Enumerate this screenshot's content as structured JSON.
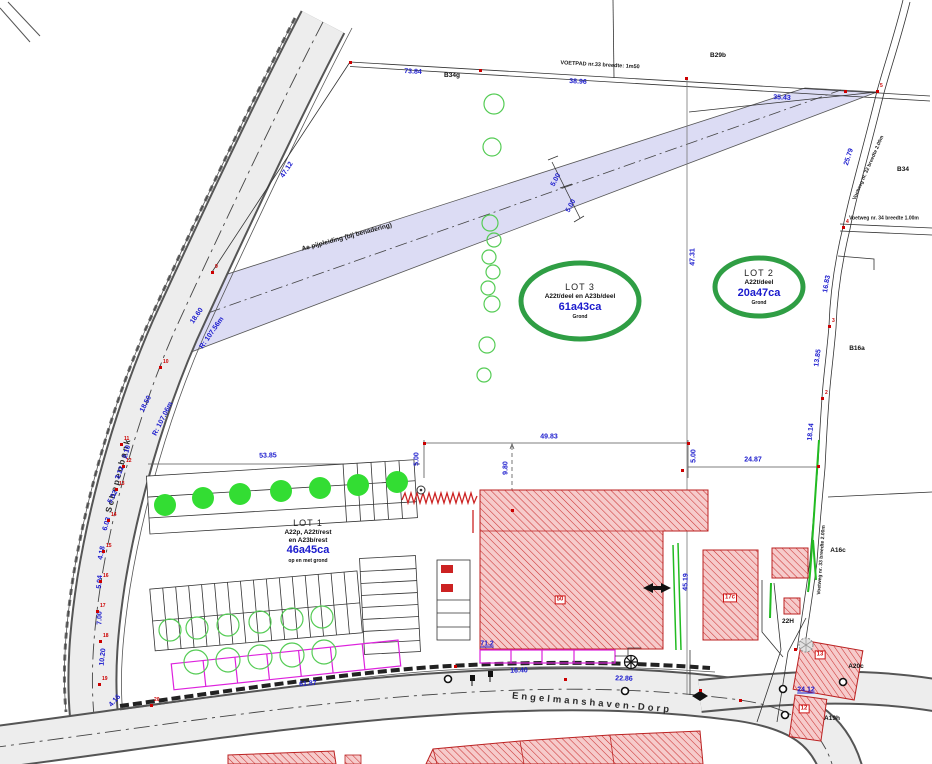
{
  "drawing": {
    "road_labels": {
      "left": "Schepenbank",
      "bottom": "Engelmanshaven-Dorp"
    },
    "lots": [
      {
        "name": "LOT 1",
        "parcels": "A22p, A22t/rest",
        "parcels2": "en A23b/rest",
        "area": "46a45ca",
        "note": "op en met grond"
      },
      {
        "name": "LOT 2",
        "parcels": "A22t/deel",
        "area": "20a47ca",
        "note": "Grond"
      },
      {
        "name": "LOT 3",
        "parcels": "A22t/deel en A23b/deel",
        "area": "61a43ca",
        "note": "Grond"
      }
    ],
    "path_labels": [
      {
        "t": "VOETPAD nr.33 breedte: 1m50",
        "x": 600,
        "y": 66,
        "r": 3,
        "s": 5.5
      },
      {
        "t": "Voetweg nr. 32 breedte 2.00m",
        "x": 869,
        "y": 168,
        "r": -66,
        "s": 5
      },
      {
        "t": "Voetweg nr. 34 breedte 1.00m",
        "x": 884,
        "y": 219,
        "r": 0,
        "s": 5
      },
      {
        "t": "Voetweg nr. 33 breedte 2.00m",
        "x": 822,
        "y": 560,
        "r": -86,
        "s": 5
      },
      {
        "t": "Ae pijpleiding (bij benadering)",
        "x": 347,
        "y": 238,
        "r": -15,
        "s": 6.5
      }
    ],
    "dimensions": [
      {
        "t": "73.84",
        "x": 413,
        "y": 72,
        "r": 3
      },
      {
        "t": "38.96",
        "x": 578,
        "y": 82,
        "r": 3
      },
      {
        "t": "35.43",
        "x": 782,
        "y": 98,
        "r": 3
      },
      {
        "t": "25.79",
        "x": 849,
        "y": 157,
        "r": -72
      },
      {
        "t": "16.83",
        "x": 827,
        "y": 284,
        "r": -80
      },
      {
        "t": "13.85",
        "x": 818,
        "y": 358,
        "r": -82
      },
      {
        "t": "18.14",
        "x": 811,
        "y": 432,
        "r": -84
      },
      {
        "t": "47.12",
        "x": 287,
        "y": 170,
        "r": -57
      },
      {
        "t": "18.60",
        "x": 197,
        "y": 316,
        "r": -55
      },
      {
        "t": "R: 107.56m",
        "x": 212,
        "y": 333,
        "r": -55
      },
      {
        "t": "18.50",
        "x": 146,
        "y": 404,
        "r": -63
      },
      {
        "t": "R: 107.06m",
        "x": 163,
        "y": 419,
        "r": -63
      },
      {
        "t": "2.10",
        "x": 127,
        "y": 452,
        "r": -75
      },
      {
        "t": "3.12",
        "x": 120,
        "y": 473,
        "r": -68
      },
      {
        "t": "5.32",
        "x": 113,
        "y": 497,
        "r": -62
      },
      {
        "t": "6.03",
        "x": 107,
        "y": 524,
        "r": -73
      },
      {
        "t": "4.18",
        "x": 102,
        "y": 553,
        "r": -79
      },
      {
        "t": "5.04",
        "x": 100,
        "y": 582,
        "r": -85
      },
      {
        "t": "7.00",
        "x": 100,
        "y": 618,
        "r": -89
      },
      {
        "t": "10.20",
        "x": 103,
        "y": 657,
        "r": -84
      },
      {
        "t": "4.16",
        "x": 115,
        "y": 701,
        "r": -48
      },
      {
        "t": "53.85",
        "x": 268,
        "y": 456,
        "r": -2
      },
      {
        "t": "49.83",
        "x": 549,
        "y": 437,
        "r": 0
      },
      {
        "t": "9.80",
        "x": 506,
        "y": 468,
        "r": -90
      },
      {
        "t": "5.00",
        "x": 417,
        "y": 459,
        "r": -90
      },
      {
        "t": "5.00",
        "x": 694,
        "y": 456,
        "r": -90
      },
      {
        "t": "24.87",
        "x": 753,
        "y": 460,
        "r": 0
      },
      {
        "t": "47.31",
        "x": 693,
        "y": 257,
        "r": -90
      },
      {
        "t": "5.00",
        "x": 556,
        "y": 180,
        "r": -62
      },
      {
        "t": "5.00",
        "x": 571,
        "y": 206,
        "r": -62
      },
      {
        "t": "45.19",
        "x": 686,
        "y": 582,
        "r": -88
      },
      {
        "t": "61.87",
        "x": 308,
        "y": 684,
        "r": -5
      },
      {
        "t": "16.40",
        "x": 519,
        "y": 671,
        "r": -2
      },
      {
        "t": "22.86",
        "x": 624,
        "y": 679,
        "r": 2
      },
      {
        "t": "71.2",
        "x": 487,
        "y": 644,
        "r": 0,
        "u": true
      },
      {
        "t": "24.12",
        "x": 806,
        "y": 690,
        "r": 0,
        "u": true
      }
    ],
    "parcel_labels": [
      {
        "t": "B34g",
        "x": 452,
        "y": 76
      },
      {
        "t": "B29b",
        "x": 718,
        "y": 56
      },
      {
        "t": "B34",
        "x": 903,
        "y": 170
      },
      {
        "t": "B16a",
        "x": 857,
        "y": 349
      },
      {
        "t": "A16c",
        "x": 838,
        "y": 551
      },
      {
        "t": "22H",
        "x": 788,
        "y": 622
      },
      {
        "t": "A20c",
        "x": 856,
        "y": 667
      },
      {
        "t": "A19h",
        "x": 832,
        "y": 719
      }
    ],
    "boxed_labels": [
      {
        "t": "50",
        "x": 560,
        "y": 600
      },
      {
        "t": "17c",
        "x": 730,
        "y": 598
      },
      {
        "t": "13",
        "x": 820,
        "y": 655
      },
      {
        "t": "12",
        "x": 804,
        "y": 709
      }
    ],
    "points": [
      {
        "x": 350,
        "y": 62
      },
      {
        "x": 480,
        "y": 70
      },
      {
        "x": 686,
        "y": 78
      },
      {
        "x": 845,
        "y": 91
      },
      {
        "x": 877,
        "y": 91,
        "n": "5"
      },
      {
        "x": 843,
        "y": 227,
        "n": "4"
      },
      {
        "x": 829,
        "y": 326,
        "n": "3"
      },
      {
        "x": 822,
        "y": 398,
        "n": "2"
      },
      {
        "x": 212,
        "y": 272,
        "n": "9"
      },
      {
        "x": 160,
        "y": 367,
        "n": "10"
      },
      {
        "x": 121,
        "y": 444,
        "n": "11"
      },
      {
        "x": 123,
        "y": 466,
        "n": "12"
      },
      {
        "x": 116,
        "y": 489,
        "n": "13"
      },
      {
        "x": 108,
        "y": 520,
        "n": "14"
      },
      {
        "x": 103,
        "y": 551,
        "n": "15"
      },
      {
        "x": 100,
        "y": 581,
        "n": "16"
      },
      {
        "x": 97,
        "y": 611,
        "n": "17"
      },
      {
        "x": 100,
        "y": 641,
        "n": "18"
      },
      {
        "x": 99,
        "y": 684,
        "n": "19"
      },
      {
        "x": 151,
        "y": 705,
        "n": "20"
      },
      {
        "x": 424,
        "y": 443
      },
      {
        "x": 688,
        "y": 443
      },
      {
        "x": 682,
        "y": 470
      },
      {
        "x": 818,
        "y": 466
      },
      {
        "x": 455,
        "y": 666
      },
      {
        "x": 565,
        "y": 679
      },
      {
        "x": 700,
        "y": 690
      },
      {
        "x": 740,
        "y": 700
      },
      {
        "x": 795,
        "y": 649
      },
      {
        "x": 512,
        "y": 510
      }
    ],
    "trees_solid": [
      [
        165,
        505
      ],
      [
        203,
        498
      ],
      [
        240,
        494
      ],
      [
        281,
        491
      ],
      [
        320,
        488
      ],
      [
        358,
        485
      ],
      [
        397,
        482
      ]
    ],
    "trees_outline": [
      [
        494,
        104,
        10
      ],
      [
        492,
        147,
        9
      ],
      [
        490,
        223,
        8
      ],
      [
        494,
        240,
        7
      ],
      [
        489,
        257,
        7
      ],
      [
        493,
        272,
        7
      ],
      [
        488,
        288,
        7
      ],
      [
        492,
        304,
        8
      ],
      [
        487,
        345,
        8
      ],
      [
        484,
        375,
        7
      ],
      [
        170,
        630,
        11
      ],
      [
        197,
        628,
        11
      ],
      [
        228,
        625,
        11
      ],
      [
        260,
        622,
        11
      ],
      [
        292,
        619,
        11
      ],
      [
        322,
        617,
        11
      ],
      [
        196,
        662,
        12
      ],
      [
        228,
        660,
        12
      ],
      [
        260,
        657,
        12
      ],
      [
        292,
        655,
        12
      ],
      [
        324,
        652,
        12
      ]
    ],
    "colors": {
      "dimension_blue": "#1a1acd",
      "point_red": "#cc0000",
      "hatch_red": "#cc3333",
      "lot_green": "#2f9e44",
      "tree_green": "#33dd33",
      "pipeline_lavender": "#dcdcf4",
      "fence_magenta": "#dd22dd",
      "road_gray": "#ededed"
    }
  }
}
